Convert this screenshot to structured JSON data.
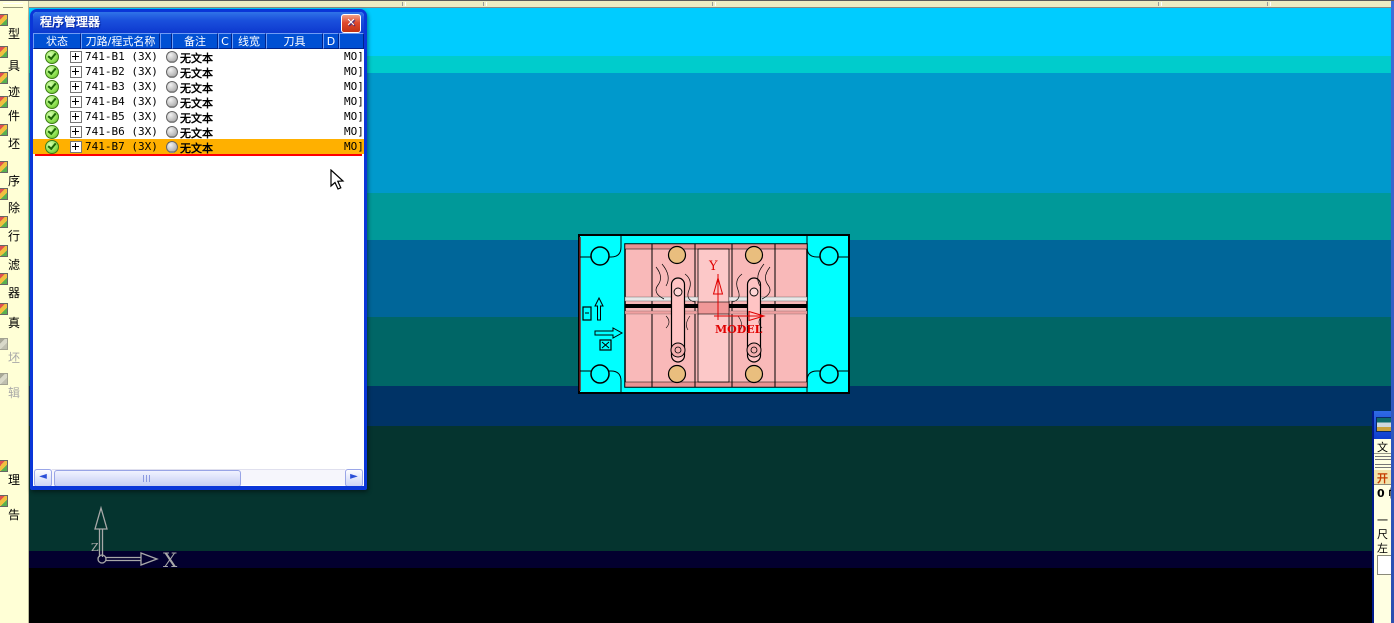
{
  "left_toolbar": {
    "items": [
      {
        "label": "型",
        "y": 24,
        "disabled": false
      },
      {
        "label": "具",
        "y": 56,
        "disabled": false
      },
      {
        "label": "迹",
        "y": 82,
        "disabled": false
      },
      {
        "label": "件",
        "y": 106,
        "disabled": false
      },
      {
        "label": "坯",
        "y": 134,
        "disabled": false
      },
      {
        "label": "序",
        "y": 171,
        "disabled": false
      },
      {
        "label": "除",
        "y": 198,
        "disabled": false
      },
      {
        "label": "行",
        "y": 226,
        "disabled": false
      },
      {
        "label": "滤",
        "y": 255,
        "disabled": false
      },
      {
        "label": "器",
        "y": 283,
        "disabled": false
      },
      {
        "label": "真",
        "y": 313,
        "disabled": false
      },
      {
        "label": "坯",
        "y": 348,
        "disabled": true
      },
      {
        "label": "辑",
        "y": 383,
        "disabled": true
      },
      {
        "label": "理",
        "y": 470,
        "disabled": false
      },
      {
        "label": "告",
        "y": 505,
        "disabled": false
      }
    ]
  },
  "program_manager": {
    "title": "程序管理器",
    "close_icon": "✕",
    "columns": [
      {
        "label": "状态",
        "w": 48
      },
      {
        "label": "刀路/程式名称",
        "w": 79
      },
      {
        "label": "",
        "w": 12
      },
      {
        "label": "备注",
        "w": 46
      },
      {
        "label": "C",
        "w": 14
      },
      {
        "label": "线宽",
        "w": 34
      },
      {
        "label": "刀具",
        "w": 57
      },
      {
        "label": "D",
        "w": 16
      },
      {
        "label": "",
        "w": 25
      }
    ],
    "rows": [
      {
        "name": "741-B1 (3X) (",
        "note": "无文本",
        "right": "MO]",
        "selected": false
      },
      {
        "name": "741-B2 (3X) (",
        "note": "无文本",
        "right": "MO]",
        "selected": false
      },
      {
        "name": "741-B3 (3X) (",
        "note": "无文本",
        "right": "MO]",
        "selected": false
      },
      {
        "name": "741-B4 (3X) (",
        "note": "无文本",
        "right": "MO]",
        "selected": false
      },
      {
        "name": "741-B5 (3X) (",
        "note": "无文本",
        "right": "MO]",
        "selected": false
      },
      {
        "name": "741-B6 (3X) (",
        "note": "无文本",
        "right": "MO]",
        "selected": false
      },
      {
        "name": "741-B7 (3X) (",
        "note": "无文本",
        "right": "MO]",
        "selected": true
      }
    ],
    "scrollbar": {
      "left_icon": "◄",
      "right_icon": "►"
    }
  },
  "viewport": {
    "bands": [
      {
        "from": 6,
        "to": 55,
        "color": "#00CCFF"
      },
      {
        "from": 55,
        "to": 72,
        "color": "#00CCCC"
      },
      {
        "from": 72,
        "to": 192,
        "color": "#0099CC"
      },
      {
        "from": 192,
        "to": 239,
        "color": "#009999"
      },
      {
        "from": 239,
        "to": 316,
        "color": "#006699"
      },
      {
        "from": 316,
        "to": 385,
        "color": "#006666"
      },
      {
        "from": 385,
        "to": 425,
        "color": "#003366"
      },
      {
        "from": 425,
        "to": 550,
        "color": "#05342F"
      },
      {
        "from": 550,
        "to": 567,
        "color": "#03002F"
      },
      {
        "from": 567,
        "to": 623,
        "color": "#000000"
      }
    ],
    "top_separators": [
      402,
      483,
      712,
      1158,
      1267
    ]
  },
  "model": {
    "y_axis_label": "Y",
    "origin_label": "MODEL",
    "plate_color": "#00FFFF",
    "insert_color": "#F9B9B9",
    "axis_color": "#E00000"
  },
  "axis_triad": {
    "x_label": "X",
    "z_label": "Z",
    "color": "#A8A8A8"
  },
  "right_dialog": {
    "rows": [
      {
        "kind": "underline",
        "label": "文"
      },
      {
        "kind": "sep",
        "label": ""
      },
      {
        "kind": "sep",
        "label": ""
      },
      {
        "kind": "button",
        "label": "开"
      },
      {
        "kind": "bold",
        "label": "0 帧"
      },
      {
        "kind": "gap",
        "label": ""
      },
      {
        "kind": "plain",
        "label": "一"
      },
      {
        "kind": "plain",
        "label": "尺"
      },
      {
        "kind": "plain",
        "label": "左"
      },
      {
        "kind": "box",
        "label": ""
      }
    ]
  }
}
